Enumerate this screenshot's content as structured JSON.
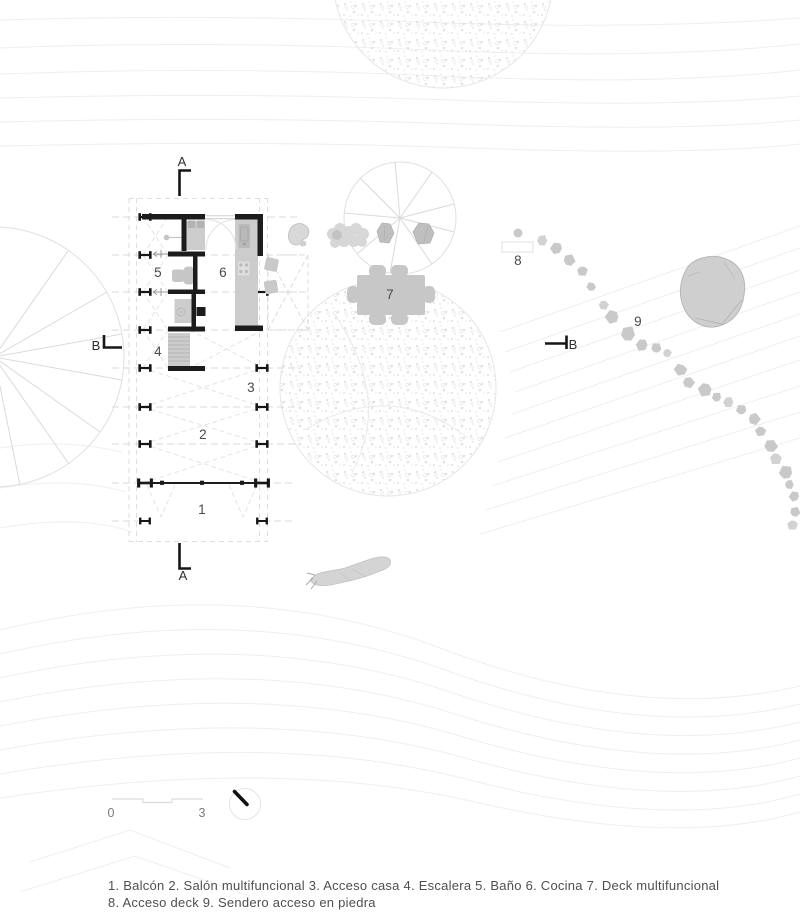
{
  "plan": {
    "room_numbers": {
      "n1": "1",
      "n2": "2",
      "n3": "3",
      "n4": "4",
      "n5": "5",
      "n6": "6",
      "n7": "7",
      "n8": "8",
      "n9": "9"
    },
    "section_markers": {
      "a_top": "A",
      "a_bottom": "A",
      "b_left": "B",
      "b_right": "B"
    }
  },
  "scale_bar": {
    "start": "0",
    "end": "3"
  },
  "legend": {
    "line1": "1. Balcón 2. Salón multifuncional 3. Acceso casa 4. Escalera 5. Baño 6. Cocina 7. Deck multifuncional",
    "line2": "8. Acceso deck 9. Sendero acceso en piedra"
  },
  "colors": {
    "wall_black": "#1c1c1c",
    "fixture_gray": "#cccccc",
    "furniture_gray": "#c7c7c7",
    "stone_gray": "#c9c9c9",
    "rock_gray": "#cfcfcf",
    "contour_gray": "#efeff0",
    "dashed_gray": "#dedede"
  }
}
